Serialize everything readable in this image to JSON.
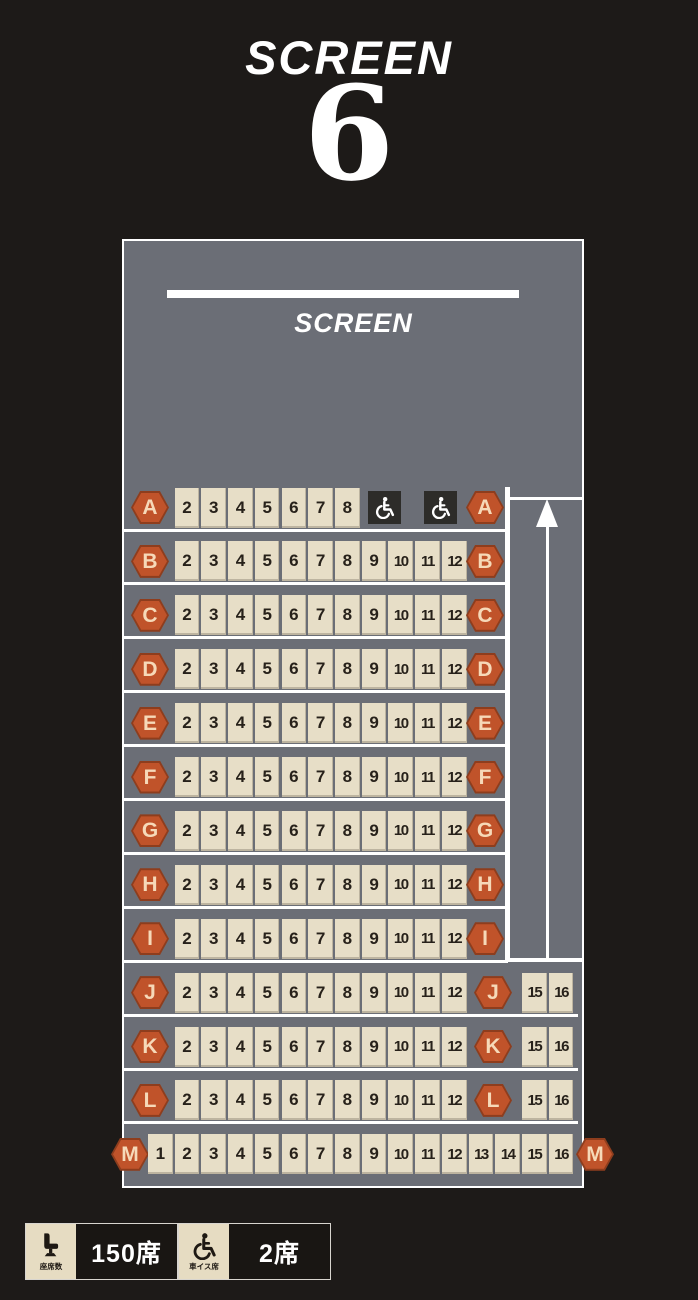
{
  "header": {
    "title": "SCREEN",
    "screen_number": "6"
  },
  "auditorium": {
    "screen_label": "SCREEN"
  },
  "rows": [
    {
      "label": "A",
      "type": "wheelchair",
      "seats": [
        "2",
        "3",
        "4",
        "5",
        "6",
        "7",
        "8"
      ],
      "wheelchair_seats": 2
    },
    {
      "label": "B",
      "type": "standard",
      "seats": [
        "2",
        "3",
        "4",
        "5",
        "6",
        "7",
        "8",
        "9",
        "10",
        "11",
        "12"
      ]
    },
    {
      "label": "C",
      "type": "standard",
      "seats": [
        "2",
        "3",
        "4",
        "5",
        "6",
        "7",
        "8",
        "9",
        "10",
        "11",
        "12"
      ]
    },
    {
      "label": "D",
      "type": "standard",
      "seats": [
        "2",
        "3",
        "4",
        "5",
        "6",
        "7",
        "8",
        "9",
        "10",
        "11",
        "12"
      ]
    },
    {
      "label": "E",
      "type": "standard",
      "seats": [
        "2",
        "3",
        "4",
        "5",
        "6",
        "7",
        "8",
        "9",
        "10",
        "11",
        "12"
      ]
    },
    {
      "label": "F",
      "type": "standard",
      "seats": [
        "2",
        "3",
        "4",
        "5",
        "6",
        "7",
        "8",
        "9",
        "10",
        "11",
        "12"
      ]
    },
    {
      "label": "G",
      "type": "standard",
      "seats": [
        "2",
        "3",
        "4",
        "5",
        "6",
        "7",
        "8",
        "9",
        "10",
        "11",
        "12"
      ]
    },
    {
      "label": "H",
      "type": "standard",
      "seats": [
        "2",
        "3",
        "4",
        "5",
        "6",
        "7",
        "8",
        "9",
        "10",
        "11",
        "12"
      ]
    },
    {
      "label": "I",
      "type": "standard",
      "seats": [
        "2",
        "3",
        "4",
        "5",
        "6",
        "7",
        "8",
        "9",
        "10",
        "11",
        "12"
      ]
    },
    {
      "label": "J",
      "type": "split",
      "seats": [
        "2",
        "3",
        "4",
        "5",
        "6",
        "7",
        "8",
        "9",
        "10",
        "11",
        "12"
      ],
      "right_seats": [
        "15",
        "16"
      ]
    },
    {
      "label": "K",
      "type": "split",
      "seats": [
        "2",
        "3",
        "4",
        "5",
        "6",
        "7",
        "8",
        "9",
        "10",
        "11",
        "12"
      ],
      "right_seats": [
        "15",
        "16"
      ]
    },
    {
      "label": "L",
      "type": "split",
      "seats": [
        "2",
        "3",
        "4",
        "5",
        "6",
        "7",
        "8",
        "9",
        "10",
        "11",
        "12"
      ],
      "right_seats": [
        "15",
        "16"
      ]
    },
    {
      "label": "M",
      "type": "full",
      "seats": [
        "1",
        "2",
        "3",
        "4",
        "5",
        "6",
        "7",
        "8",
        "9",
        "10",
        "11",
        "12",
        "13",
        "14",
        "15",
        "16"
      ]
    }
  ],
  "aisle": {
    "arrow_direction": "up"
  },
  "legend": {
    "items": [
      {
        "icon": "reclining-seat-icon",
        "caption": "座席数",
        "value": "150席"
      },
      {
        "icon": "wheelchair-icon",
        "caption": "車イス席",
        "value": "2席"
      }
    ]
  },
  "colors": {
    "background": "#1d1a18",
    "panel_gray": "#6b6e76",
    "seat_cream": "#e7dec7",
    "row_badge_orange": "#c0532a",
    "badge_letter": "#f6d9b8",
    "wheelchair_box": "#2d2c29",
    "lines_white": "#ffffff"
  }
}
